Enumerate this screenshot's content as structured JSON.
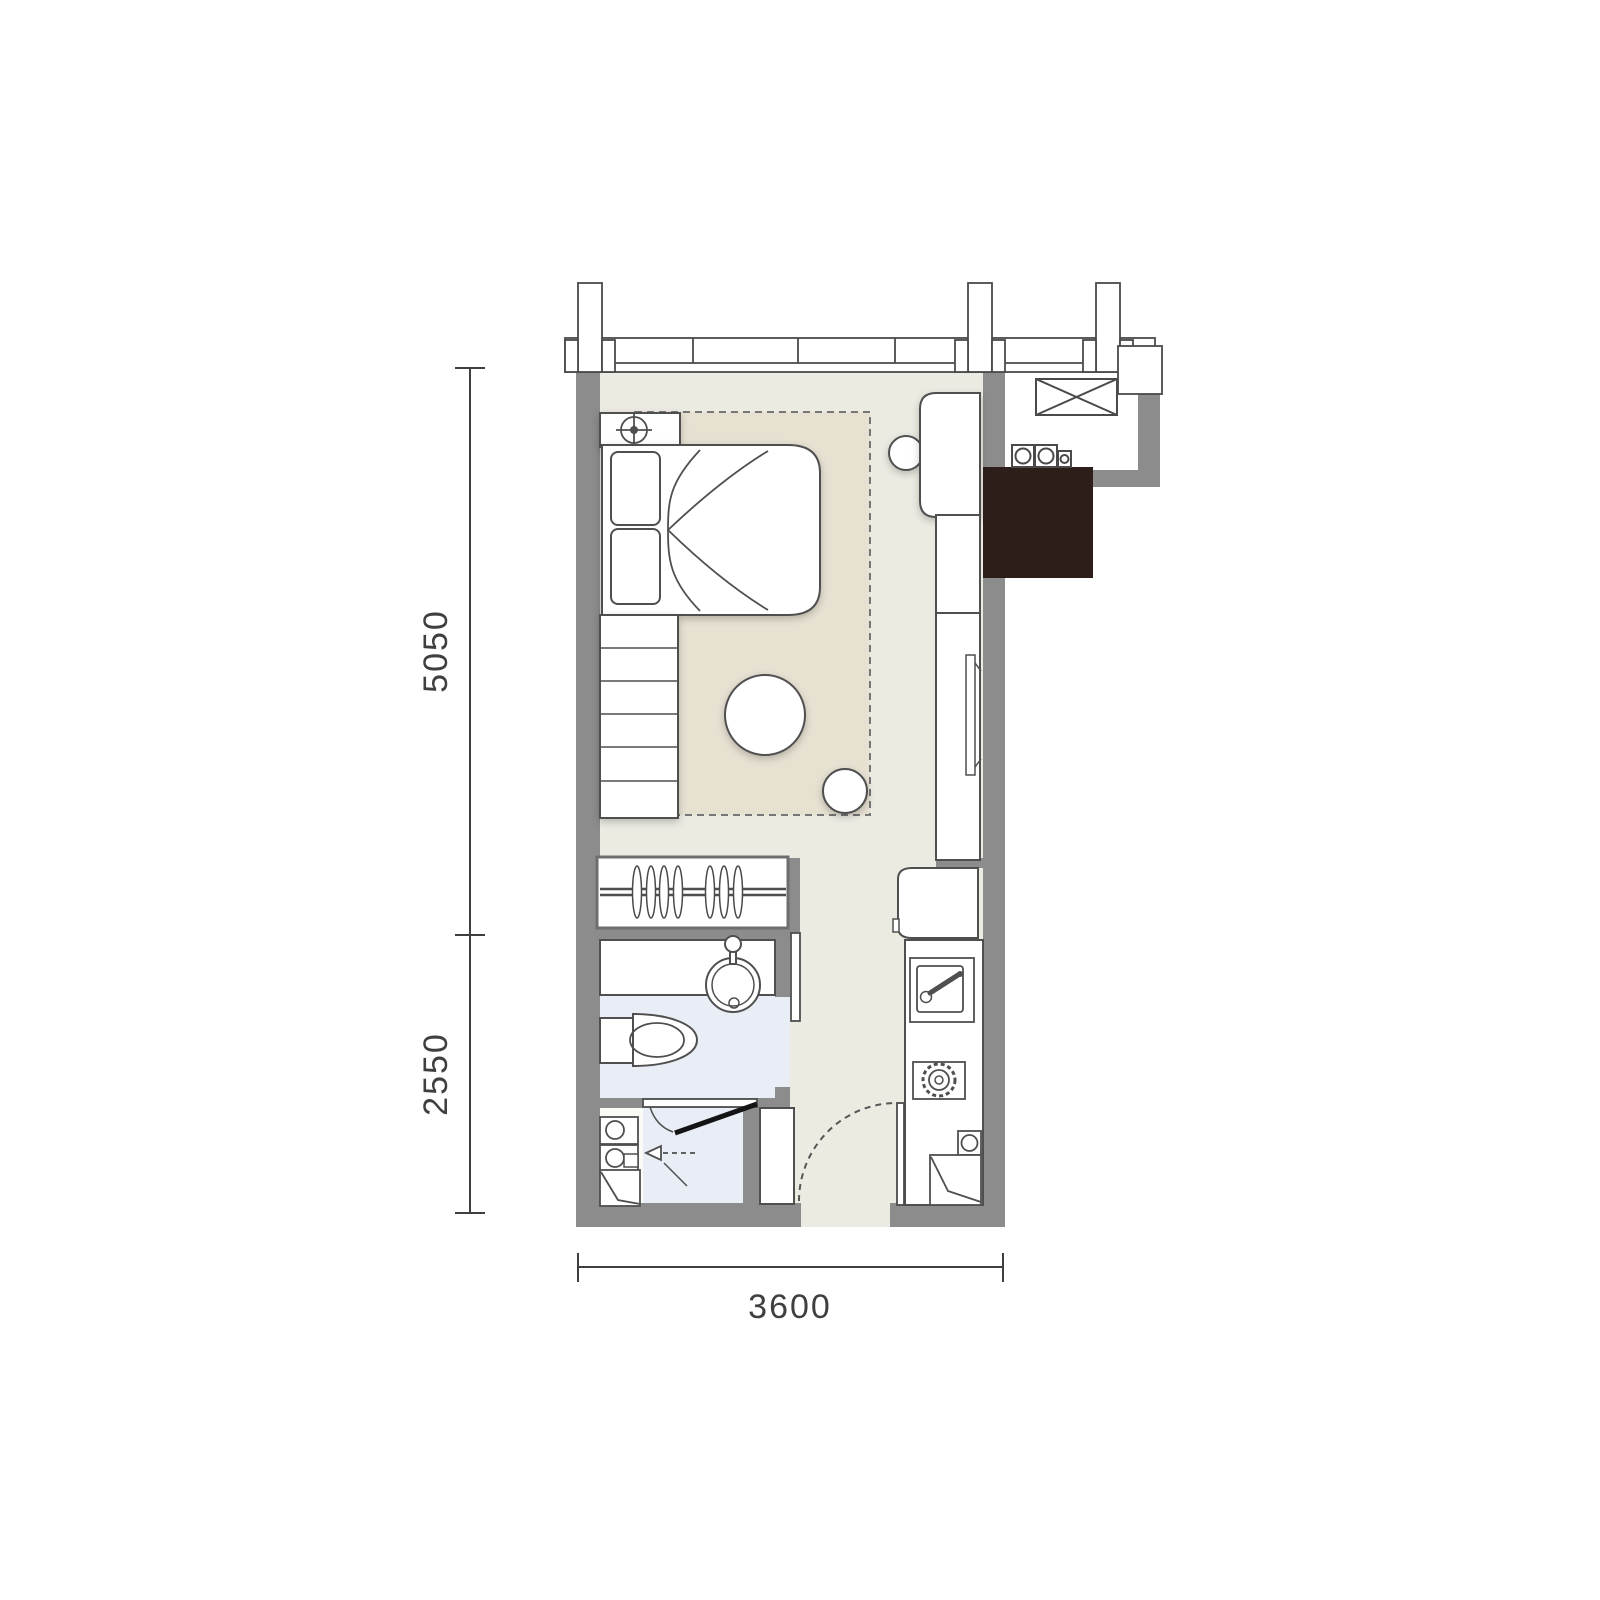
{
  "page": {
    "type": "apartment-floor-plan",
    "background": "#ffffff"
  },
  "dimensions": {
    "left_upper": {
      "label": "5050"
    },
    "left_lower": {
      "label": "2550"
    },
    "bottom": {
      "label": "3600"
    }
  },
  "palette": {
    "wall": "#8c8c8c",
    "floor": "#ecebe2",
    "rug": "#e7e1d2",
    "wet_floor": "#e9edf5",
    "laundry_floor": "#fafaf7",
    "shaft": "#2d1e1a",
    "line": "#4f4f4f",
    "door_line": "#141414",
    "dim_text": "#3f3f3f",
    "furniture_fill": "#ffffff"
  },
  "icons": [
    "window-wall",
    "column-icon",
    "ac-platform-xbox-icon",
    "meter-icon",
    "lamp-icon",
    "bed",
    "pillow",
    "rug",
    "round-table",
    "stool",
    "desk",
    "chair",
    "tv-icon",
    "cabinet",
    "wardrobe-hangers-icon",
    "vanity",
    "basin-icon",
    "faucet-icon",
    "toilet-icon",
    "sliding-door",
    "shower-door",
    "shower-head-icon",
    "washer-icon",
    "laundry-fold-icon",
    "fridge",
    "kitchen-sink-icon",
    "gas-stove-icon",
    "entry-door-arc",
    "service-shaft",
    "dimension-line"
  ]
}
